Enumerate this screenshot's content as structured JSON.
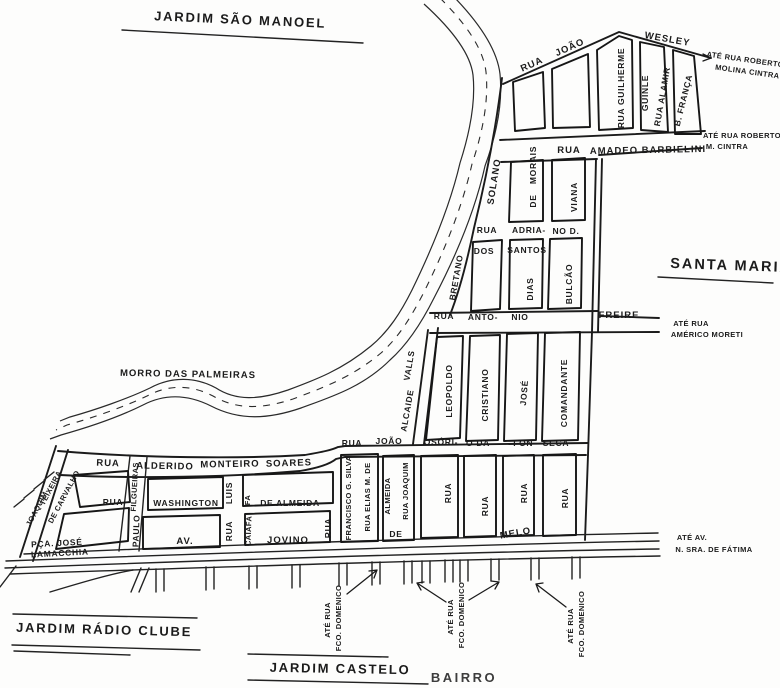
{
  "map": {
    "type": "scanned neighborhood street map",
    "areas": {
      "jardim_sao_manoel": "JARDIM SÃO MANOEL",
      "santa_maria": "SANTA MARIA",
      "morro_das_palmeiras": "MORRO DAS PALMEIRAS",
      "jardim_radio_clube": "JARDIM RÁDIO CLUBE",
      "jardim_castelo": "JARDIM CASTELO",
      "bairro": "BAIRRO",
      "pca_jose": "PÇA. JOSÉ",
      "lamacchia": "LAMACCHIA"
    },
    "streets": {
      "rua": "RUA",
      "joao": "JOÃO",
      "wesley": "WESLEY",
      "rua_guilherme": "RUA GUILHERME",
      "guinle": "GUINLE",
      "rua_alamir": "RUA ALAMIR",
      "b_franca": "B. FRANÇA",
      "amadeo_barbielini": "AMADEO BARBIELINI",
      "solano": "SOLANO",
      "morais": "MORAIS",
      "de": "DE",
      "viana": "VIANA",
      "adria": "ADRIA-",
      "no_d": "NO D.",
      "dos": "DOS",
      "santos": "SANTOS",
      "dias": "DIAS",
      "bulcao": "BULCÃO",
      "bretano": "BRETANO",
      "anto": "ANTO-",
      "nio": "NIO",
      "freire": "FREIRE",
      "alcaide": "ALCAIDE",
      "valls": "VALLS",
      "leopoldo": "LEOPOLDO",
      "cristiano": "CRISTIANO",
      "jose": "JOSÉ",
      "comandante": "COMANDANTE",
      "osori": "OSÓRI-",
      "o_da": "O DA",
      "fon": "FON-",
      "seca": "SECA",
      "alderido": "ALDERIDO",
      "monteiro": "MONTEIRO",
      "soares": "SOARES",
      "filgueiras": "FILGUEIRAS",
      "paulo": "PAULO",
      "washington": "WASHINGTON",
      "luis": "LUIS",
      "fa": "FA",
      "de_almeida": "DE ALMEIDA",
      "av": "AV.",
      "caiafa": "CAIAFA",
      "jovino": "JOVINO",
      "francisco_g_silva": "FRANCISCO G. SILVA",
      "rua_elias_m_de": "RUA ELIAS M. DE",
      "almeida": "ALMEIDA",
      "rua_joaquim": "RUA JOAQUIM",
      "melo": "MELO",
      "joaquim": "JOAQUIM",
      "teixeira": "TEIXEIRA",
      "de_carvalho": "DE CARVALHO"
    },
    "connections": {
      "ate_rua_roberto": "ATÉ RUA ROBERTO",
      "molina_cintra": "MOLINA CINTRA",
      "m_cintra": "M. CINTRA",
      "ate_rua": "ATÉ RUA",
      "americo_moreti": "AMÉRICO MORETI",
      "ate_av": "ATÉ AV.",
      "n_sra_de_fatima": "N. SRA. DE FÁTIMA",
      "fco_domenico": "FCO. DOMENICO"
    },
    "ink_color": "#1b1b1b",
    "paper_color": "#fdfdfc"
  }
}
